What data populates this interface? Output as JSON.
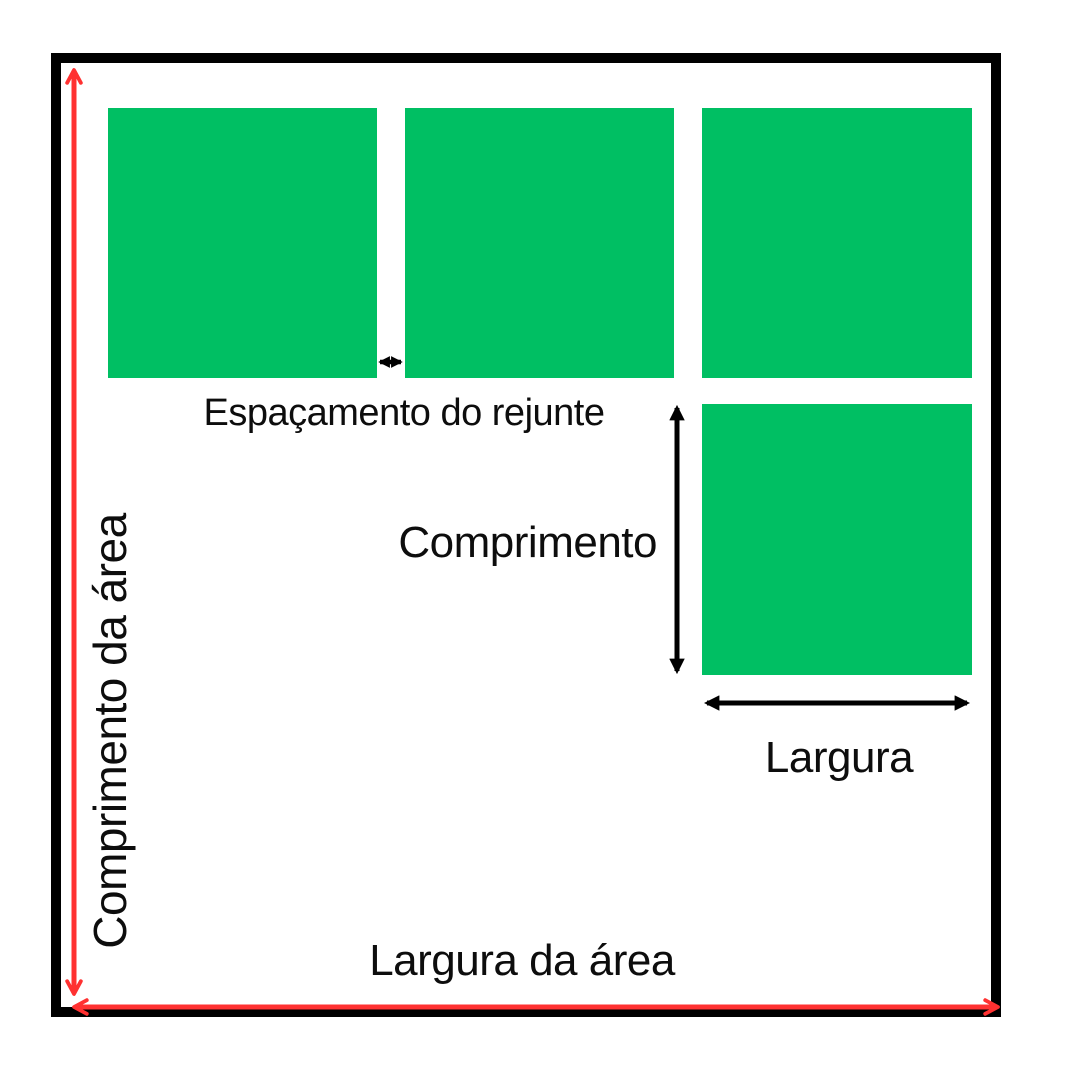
{
  "page": {
    "background": "#FFFFFF"
  },
  "diagram": {
    "colors": {
      "tile_green": "#00BF63",
      "arrow_red": "#FF3131",
      "line_black": "#000000"
    },
    "labels": {
      "grout_spacing": "Espaçamento do rejunte",
      "tile_length": "Comprimento",
      "tile_width": "Largura",
      "area_width": "Largura da área",
      "area_length": "Comprimento da área"
    },
    "tile_count": 4
  }
}
